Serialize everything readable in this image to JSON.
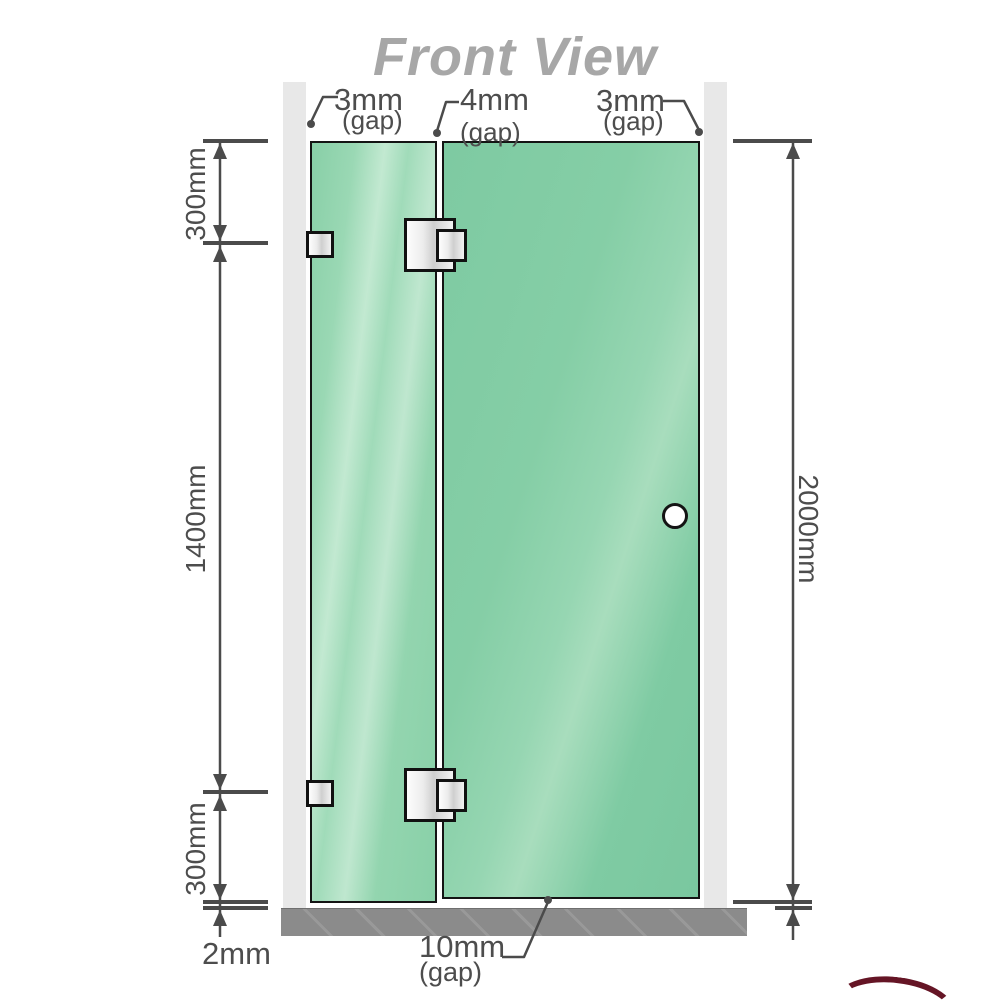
{
  "title": "Front View",
  "annotations": {
    "gap_left": {
      "value": "3mm",
      "suffix": "(gap)"
    },
    "gap_middle": {
      "value": "4mm",
      "suffix": "(gap)"
    },
    "gap_right": {
      "value": "3mm",
      "suffix": "(gap)"
    },
    "bottom_gap": {
      "value": "10mm",
      "suffix": "(gap)"
    },
    "floor_gap": {
      "value": "2mm"
    }
  },
  "dimensions": {
    "top_left_segment": "300mm",
    "middle_left_segment": "1400mm",
    "bottom_left_segment": "300mm",
    "right_overall": "2000mm"
  },
  "colors": {
    "glass_green": "#86cfa8",
    "glass_highlight": "#c2e9d1",
    "wall_gray": "#e8e8e8",
    "floor_gray": "#8b8b8b",
    "dimension_line": "#4b4b4b",
    "title_gray": "#a7a7a7",
    "hardware_border": "#111111",
    "logo_red": "#651525"
  }
}
